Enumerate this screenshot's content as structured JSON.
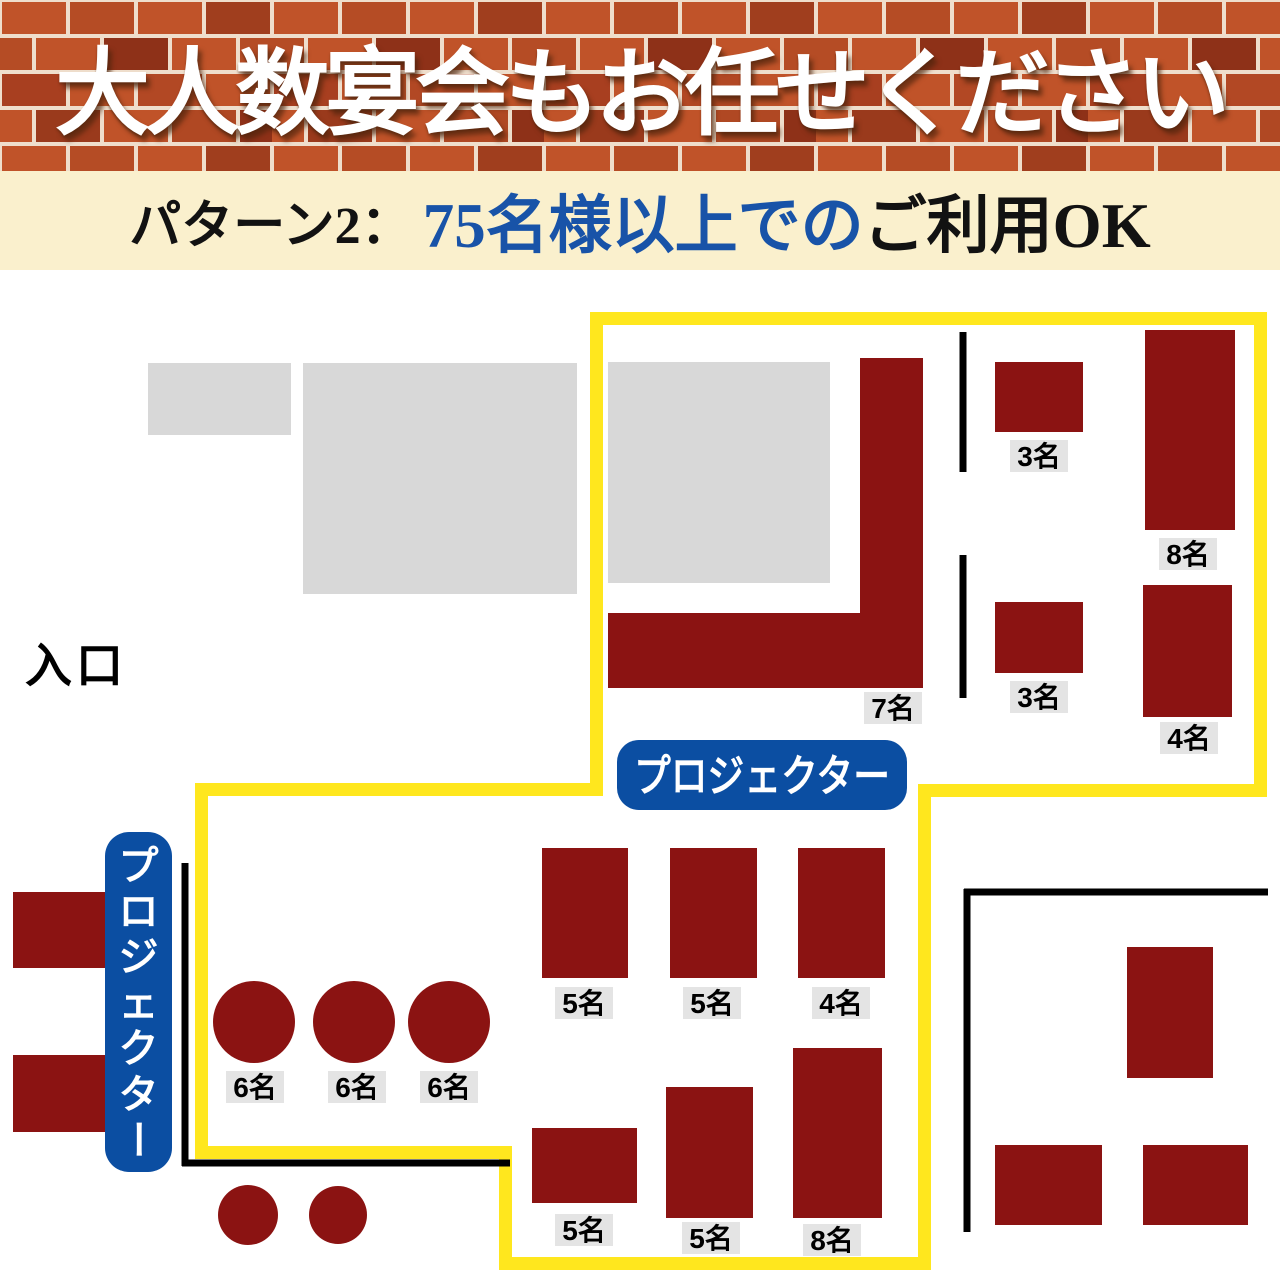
{
  "header": {
    "title": "大人数宴会もお任せください",
    "mortar_color": "#EFDECC",
    "brick_colors": [
      "#C05329",
      "#B54C25",
      "#A03E1E",
      "#8E3118",
      "#B24824",
      "#9A3A1C"
    ]
  },
  "subbanner": {
    "prefix": "パターン2：",
    "highlight": "75名様以上での",
    "suffix": "ご利用OK",
    "bg": "#FAF0CD",
    "highlight_color": "#1853A8",
    "text_color": "#121212"
  },
  "floorplan": {
    "colors": {
      "table": "#8B1312",
      "zone_outline": "#FFE71E",
      "wall": "#000000",
      "label_bg": "#E4E4E4",
      "label_text": "#000000",
      "projector_bg": "#0B4EA2",
      "projector_text": "#FFFFFF",
      "gray_area": "#D8D8D8"
    },
    "entrance_label": {
      "id": "entrance-label",
      "text": "入口",
      "x": 25,
      "y": 682,
      "font_size": 47
    },
    "zone_outline": {
      "id": "party-zone-outline",
      "points": "596.5,318.5 1260.5,318.5 1260.5,790.5 924.5,790.5 924.5,1263.5 505.5,1263.5 505.5,1152.5 201.5,1152.5 201.5,789.5 596.5,789.5",
      "stroke_width": 13
    },
    "gray_areas": [
      {
        "id": "gray-area-1",
        "x": 148,
        "y": 363,
        "w": 143,
        "h": 72
      },
      {
        "id": "gray-area-2",
        "x": 303,
        "y": 363,
        "w": 274,
        "h": 231
      },
      {
        "id": "gray-area-3",
        "x": 608,
        "y": 362,
        "w": 222,
        "h": 221
      }
    ],
    "walls": [
      {
        "id": "wall-upper-right-a",
        "x1": 963,
        "y1": 332,
        "x2": 963,
        "y2": 472
      },
      {
        "id": "wall-upper-right-b",
        "x1": 963,
        "y1": 555,
        "x2": 963,
        "y2": 698
      },
      {
        "id": "wall-left-vertical",
        "x1": 185,
        "y1": 863,
        "x2": 185,
        "y2": 1166
      },
      {
        "id": "wall-left-horizontal",
        "x1": 182,
        "y1": 1163,
        "x2": 510,
        "y2": 1163
      },
      {
        "id": "wall-lower-right-top",
        "x1": 964,
        "y1": 892,
        "x2": 1268,
        "y2": 892
      },
      {
        "id": "wall-lower-right-side",
        "x1": 967,
        "y1": 889,
        "x2": 967,
        "y2": 1232
      }
    ],
    "tables": [
      {
        "id": "table-7-l-shape",
        "shape": "polygon",
        "points": "860,358 923,358 923,688 608,688 608,613 860,613",
        "label": "7名",
        "label_x": 893,
        "label_y": 708
      },
      {
        "id": "table-3-upper",
        "shape": "rect",
        "x": 995,
        "y": 362,
        "w": 88,
        "h": 70,
        "label": "3名",
        "label_x": 1039,
        "label_y": 456
      },
      {
        "id": "table-8-upper",
        "shape": "rect",
        "x": 1145,
        "y": 330,
        "w": 90,
        "h": 200,
        "label": "8名",
        "label_x": 1188,
        "label_y": 554
      },
      {
        "id": "table-3-lower",
        "shape": "rect",
        "x": 995,
        "y": 602,
        "w": 88,
        "h": 71,
        "label": "3名",
        "label_x": 1039,
        "label_y": 697
      },
      {
        "id": "table-4-upper",
        "shape": "rect",
        "x": 1143,
        "y": 585,
        "w": 89,
        "h": 132,
        "label": "4名",
        "label_x": 1189,
        "label_y": 738
      },
      {
        "id": "table-5-row1-a",
        "shape": "rect",
        "x": 542,
        "y": 848,
        "w": 86,
        "h": 130,
        "label": "5名",
        "label_x": 584,
        "label_y": 1003
      },
      {
        "id": "table-5-row1-b",
        "shape": "rect",
        "x": 670,
        "y": 848,
        "w": 87,
        "h": 130,
        "label": "5名",
        "label_x": 712,
        "label_y": 1003
      },
      {
        "id": "table-4-row1",
        "shape": "rect",
        "x": 798,
        "y": 848,
        "w": 87,
        "h": 130,
        "label": "4名",
        "label_x": 841,
        "label_y": 1003
      },
      {
        "id": "table-5-row2-a",
        "shape": "rect",
        "x": 532,
        "y": 1128,
        "w": 105,
        "h": 75,
        "label": "5名",
        "label_x": 584,
        "label_y": 1230
      },
      {
        "id": "table-5-row2-b",
        "shape": "rect",
        "x": 666,
        "y": 1087,
        "w": 87,
        "h": 131,
        "label": "5名",
        "label_x": 711,
        "label_y": 1238
      },
      {
        "id": "table-8-row2",
        "shape": "rect",
        "x": 793,
        "y": 1048,
        "w": 89,
        "h": 170,
        "label": "8名",
        "label_x": 832,
        "label_y": 1240
      },
      {
        "id": "table-left-a",
        "shape": "rect",
        "x": 13,
        "y": 892,
        "w": 92,
        "h": 76,
        "label": null
      },
      {
        "id": "table-left-b",
        "shape": "rect",
        "x": 13,
        "y": 1055,
        "w": 92,
        "h": 77,
        "label": null
      },
      {
        "id": "table-right-vertical",
        "shape": "rect",
        "x": 1127,
        "y": 947,
        "w": 86,
        "h": 131,
        "label": null
      },
      {
        "id": "table-right-bottom-a",
        "shape": "rect",
        "x": 995,
        "y": 1145,
        "w": 107,
        "h": 80,
        "label": null
      },
      {
        "id": "table-right-bottom-b",
        "shape": "rect",
        "x": 1143,
        "y": 1145,
        "w": 105,
        "h": 80,
        "label": null
      },
      {
        "id": "table-round-6-a",
        "shape": "circle",
        "cx": 254,
        "cy": 1022,
        "r": 41,
        "label": "6名",
        "label_x": 255,
        "label_y": 1087
      },
      {
        "id": "table-round-6-b",
        "shape": "circle",
        "cx": 354,
        "cy": 1022,
        "r": 41,
        "label": "6名",
        "label_x": 357,
        "label_y": 1087
      },
      {
        "id": "table-round-6-c",
        "shape": "circle",
        "cx": 449,
        "cy": 1022,
        "r": 41,
        "label": "6名",
        "label_x": 449,
        "label_y": 1087
      },
      {
        "id": "table-round-small-a",
        "shape": "circle",
        "cx": 248,
        "cy": 1215,
        "r": 30,
        "label": null
      },
      {
        "id": "table-round-small-b",
        "shape": "circle",
        "cx": 338,
        "cy": 1215,
        "r": 29,
        "label": null
      }
    ],
    "projector_labels": [
      {
        "id": "projector-label-main",
        "text": "プロジェクター",
        "orientation": "horizontal",
        "x": 617,
        "y": 740,
        "w": 290,
        "h": 70,
        "rx": 22,
        "font_size": 44
      },
      {
        "id": "projector-label-side",
        "text": "プロジェクター",
        "orientation": "vertical",
        "x": 105,
        "y": 832,
        "w": 67,
        "h": 340,
        "rx": 24,
        "font_size": 40
      }
    ],
    "capacity_label_style": {
      "w": 58,
      "h": 32,
      "font_size": 28
    }
  }
}
